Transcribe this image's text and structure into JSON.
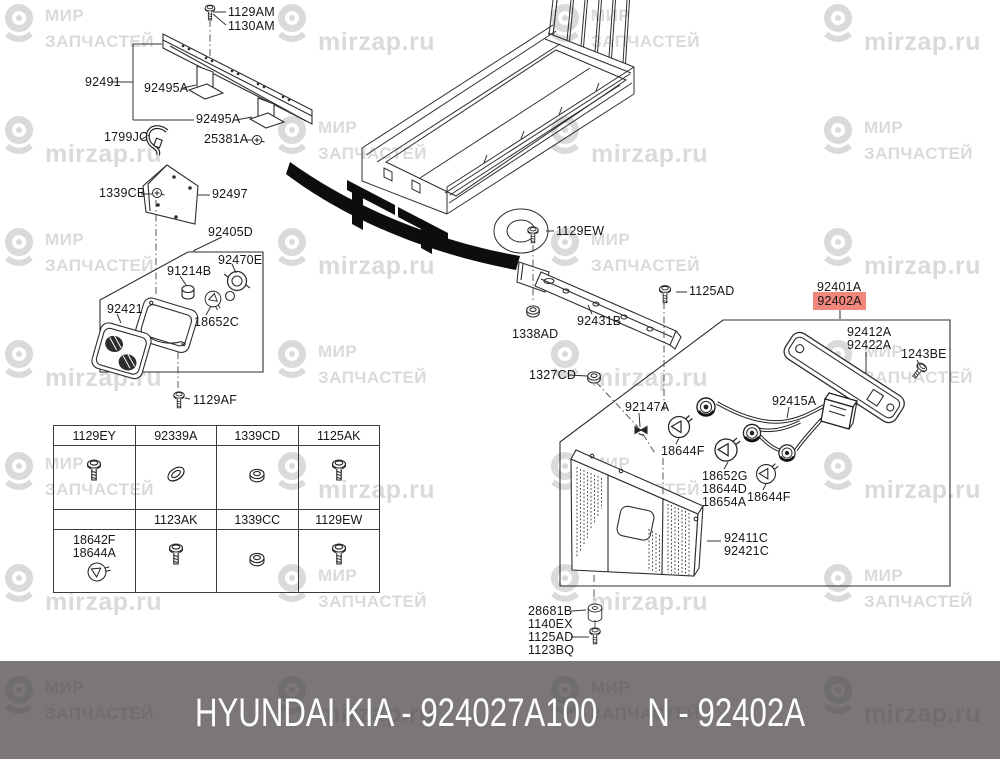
{
  "watermark": {
    "brand_line1": "МИР",
    "brand_line2": "ЗАПЧАСТЕЙ",
    "site": "mirzap.ru"
  },
  "footer": {
    "left": "HYUNDAI  KIA - 924027A100",
    "right": "N - 92402A"
  },
  "highlight": {
    "bg": "#f1867d",
    "fg": "#693c36"
  },
  "diagram": {
    "labels": {
      "l1129am": "1129AM",
      "l1130am": "1130AM",
      "l92491": "92491",
      "l92495a_1": "92495A",
      "l92495a_2": "92495A",
      "l1799jc": "1799JC",
      "l25381a": "25381A",
      "l1339cb": "1339CB",
      "l92497": "92497",
      "l92405d": "92405D",
      "l92470e": "92470E",
      "l91214b": "91214B",
      "l92421": "92421",
      "l18652c": "18652C",
      "l1129af": "1129AF",
      "l1129ew": "1129EW",
      "l1125ad": "1125AD",
      "l92431b": "92431B",
      "l1338ad": "1338AD",
      "l1327cd": "1327CD",
      "l92147a": "92147A",
      "l18644f_left": "18644F",
      "l18652g": "18652G",
      "l18644d": "18644D",
      "l18654a": "18654A",
      "l18644f_right": "18644F",
      "l92411c": "92411C",
      "l92421c": "92421C",
      "l92415a": "92415A",
      "l92401a": "92401A",
      "l92402a": "92402A",
      "l92412a": "92412A",
      "l92422a": "92422A",
      "l1243be": "1243BE",
      "l28681b": "28681B",
      "l1140ex": "1140EX",
      "l1125ad_2": "1125AD",
      "l1123bq": "1123BQ"
    },
    "icons": {
      "bolt": "flange-bolt-icon",
      "nut": "nut-icon",
      "bulb": "wedge-bulb-icon",
      "socket": "bulb-socket-icon",
      "clip": "retainer-clip-icon",
      "screw_small": "small-screw-icon",
      "bushing": "rubber-bushing-icon",
      "hook": "wire-hook-icon",
      "logo": "mirzap-pin-icon"
    }
  },
  "table": {
    "r1c1": "1129EY",
    "r1c2": "92339A",
    "r1c3": "1339CD",
    "r1c4": "1125AK",
    "r2c2": "1123AK",
    "r2c3": "1339CC",
    "r2c4": "1129EW",
    "bulb_line1": "18642F",
    "bulb_line2": "18644A"
  }
}
